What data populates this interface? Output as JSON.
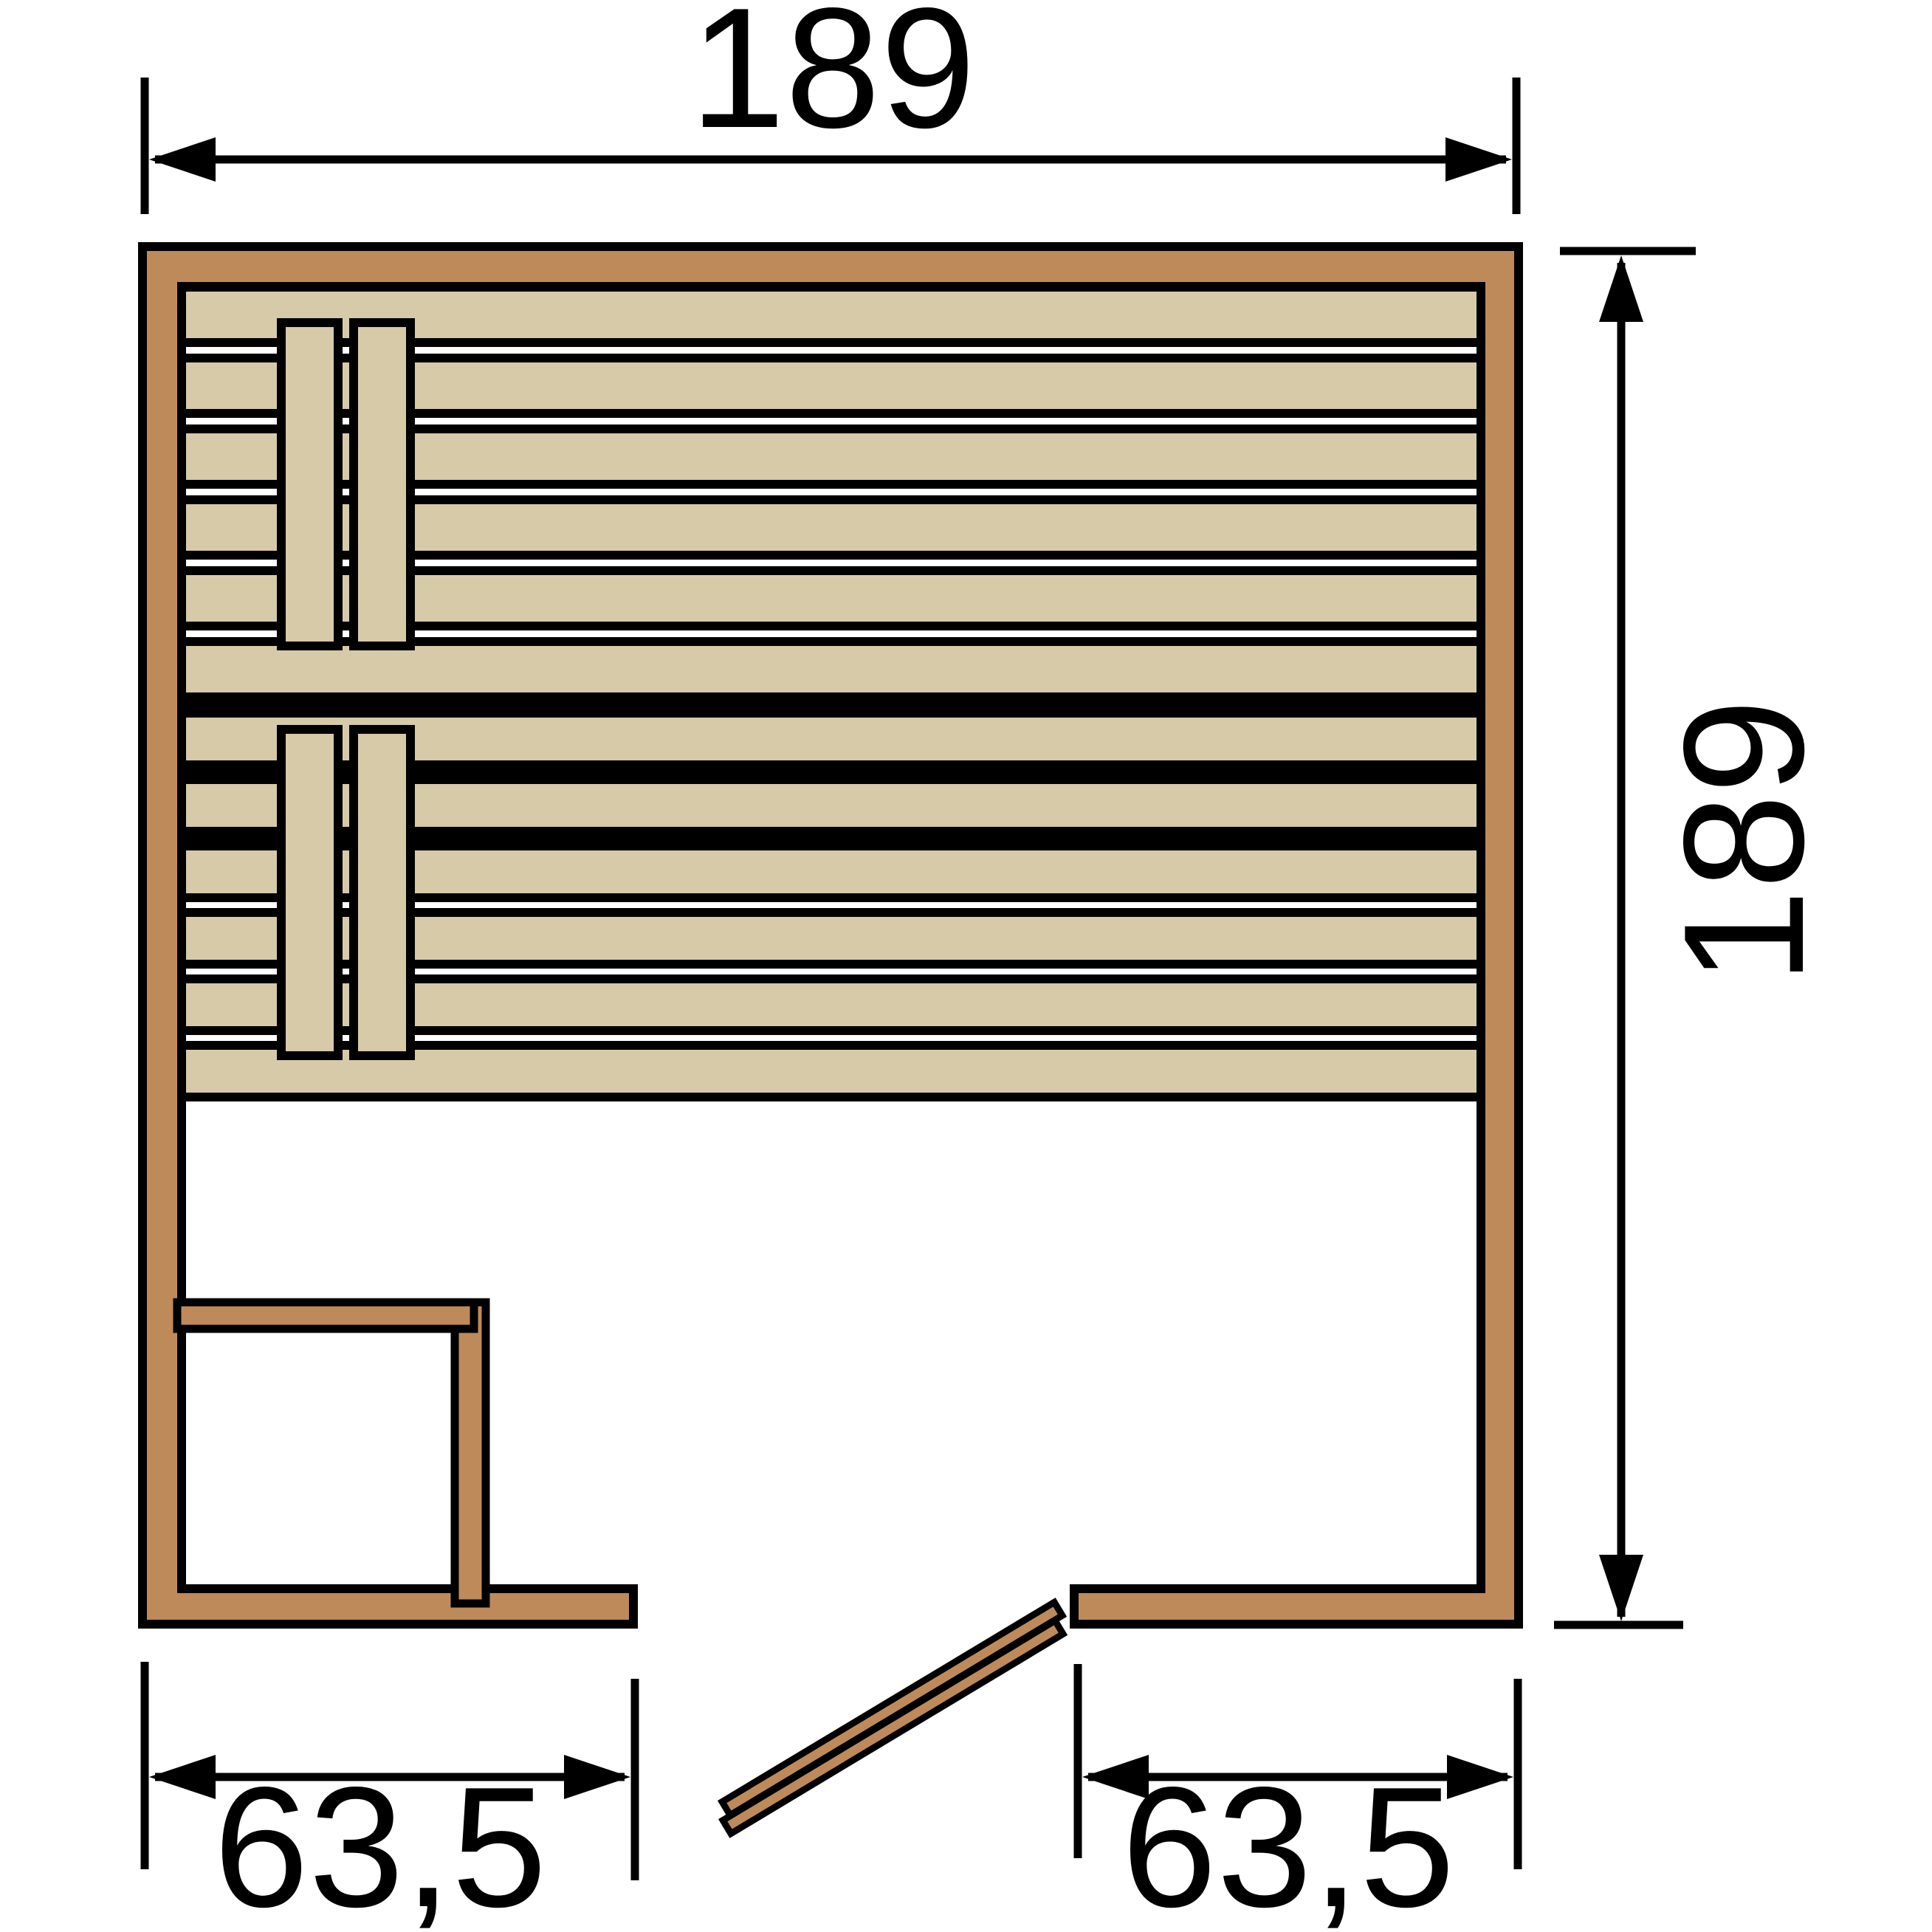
{
  "diagram": {
    "dimensions": {
      "top": {
        "label": "189"
      },
      "right": {
        "label": "189"
      },
      "bottom_left": {
        "label": "63,5"
      },
      "bottom_right": {
        "label": "63,5"
      }
    },
    "colors": {
      "line": "#000000",
      "wall": "#BE8A5A",
      "bench": "#D6CAA8",
      "floor": "#FFFFFF"
    }
  }
}
